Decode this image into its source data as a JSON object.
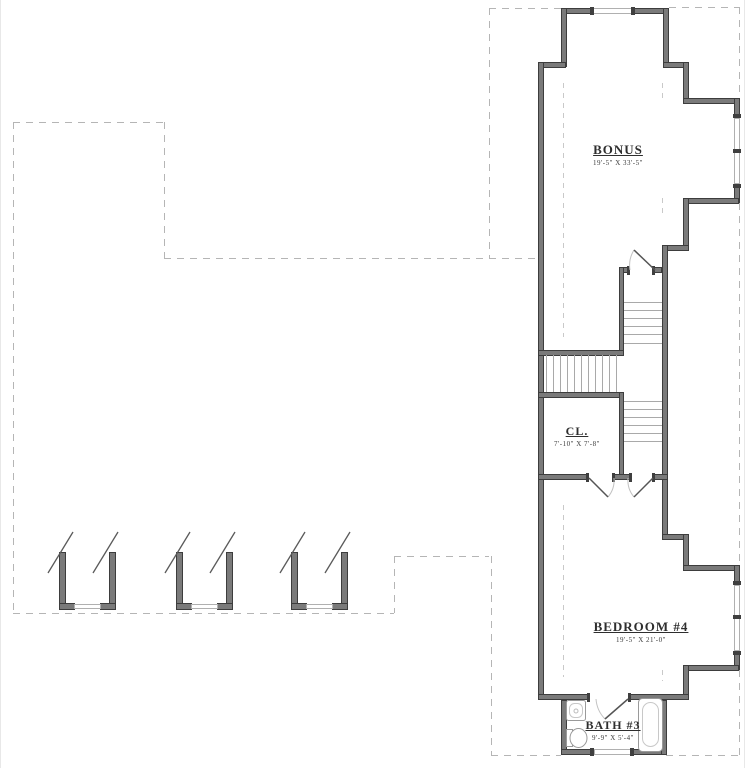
{
  "plan": {
    "type": "second-floor-plan",
    "rooms": [
      {
        "name": "BONUS",
        "dims": "19'-5\" X 33'-5\""
      },
      {
        "name": "CL.",
        "dims": "7'-10\" X 7'-8\""
      },
      {
        "name": "BEDROOM  #4",
        "dims": "19'-5\" X 21'-0\""
      },
      {
        "name": "BATH  #3",
        "dims": "9'-9\" X 5'-4\""
      }
    ],
    "fixtures": [
      "shower",
      "toilet",
      "bathtub"
    ],
    "colors": {
      "wall": "#3d3d3d",
      "wall_fill": "#7a7a7a",
      "dashed_outline": "#b5b5b5",
      "text": "#2e2e2e",
      "background": "#ffffff"
    }
  }
}
